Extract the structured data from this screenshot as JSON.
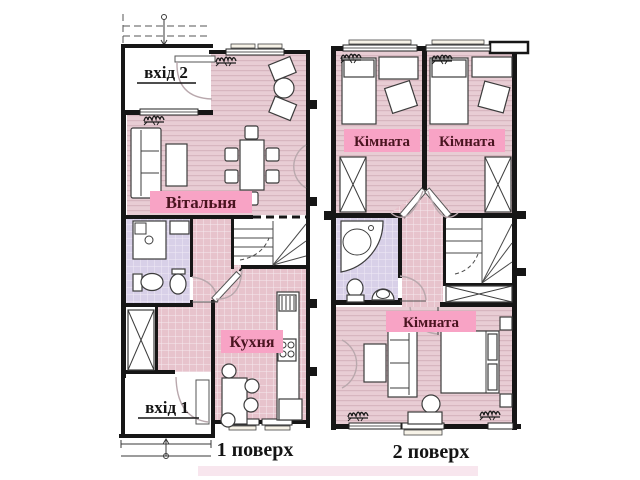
{
  "document": {
    "type": "apartment floor plan, two levels",
    "language": "uk"
  },
  "colors": {
    "label_bg": "#f8a3c5",
    "label_text": "#4a1420",
    "wall": "#161616",
    "floor_wood_pink": "#e8cdd4",
    "floor_tile_pink": "#e7c3cc",
    "floor_tile_lavender": "#d8d0e8",
    "watermark_strip": "#f6dde8"
  },
  "floor1": {
    "caption": "1 поверх",
    "entrance_top_label": "вхід 2",
    "entrance_bottom_label": "вхід 1",
    "living_room_label": "Вітальня",
    "kitchen_label": "Кухня"
  },
  "floor2": {
    "caption": "2 поверх",
    "bedroom1_label": "Кімната",
    "bedroom2_label": "Кімната",
    "bedroom3_label": "Кімната"
  }
}
